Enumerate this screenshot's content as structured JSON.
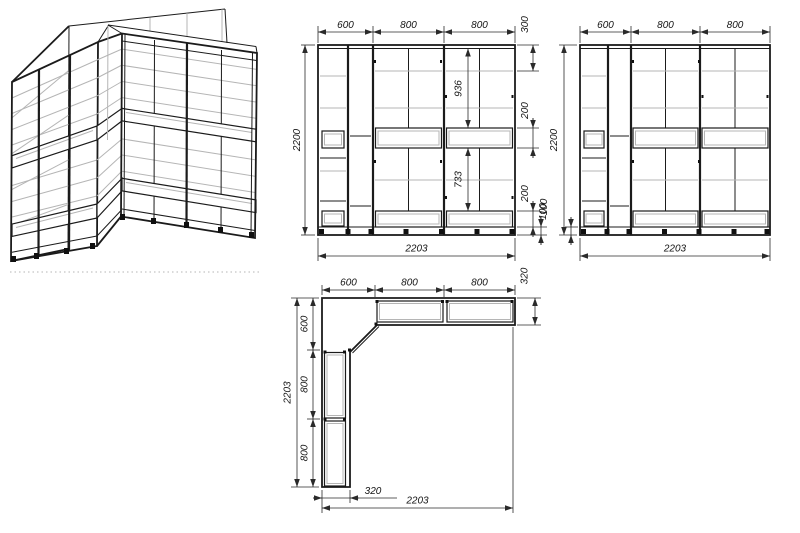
{
  "drawing": {
    "front_left": {
      "top": [
        "600",
        "800",
        "800"
      ],
      "height": "2200",
      "width": "2203",
      "right": {
        "r300": "300",
        "r936": "936",
        "r200a": "200",
        "r733": "733",
        "r200b": "200",
        "r100": "100"
      }
    },
    "front_right": {
      "top": [
        "600",
        "800",
        "800"
      ],
      "height": "2200",
      "base": "100",
      "width": "2203"
    },
    "plan": {
      "top": [
        "600",
        "800",
        "800"
      ],
      "right_depth": "320",
      "left_total": "2203",
      "left": [
        "600",
        "800",
        "800"
      ],
      "bottom_depth": "320",
      "bottom_total": "2203"
    },
    "colors": {
      "background": "#ffffff",
      "line": "#1b1b1b",
      "shelf_gray": "#b5b5b5",
      "dimension": "#2a2a2a"
    }
  }
}
